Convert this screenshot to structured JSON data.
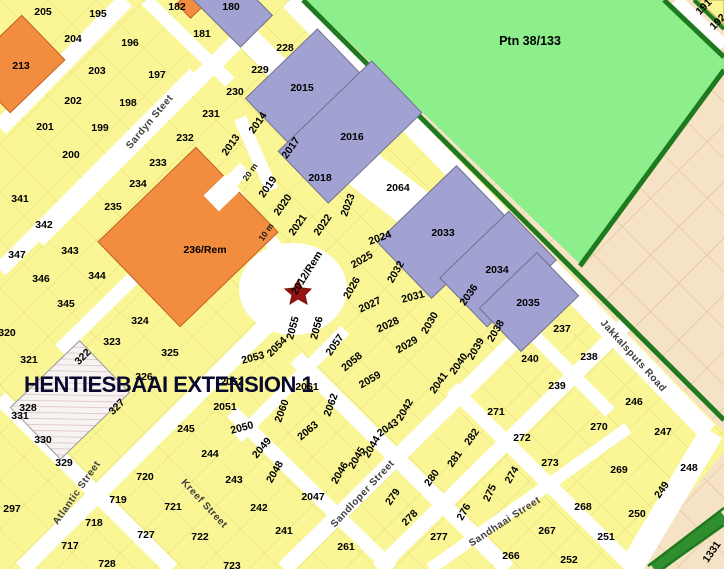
{
  "map": {
    "title": "HENTIESBAAI EXTENSION 1",
    "region_label": {
      "label": "Ptn 38/133",
      "x": 530,
      "y": 41
    },
    "marker": {
      "name": "red-star-marker",
      "x": 298,
      "y": 291,
      "color": "#9a1212"
    },
    "colors": {
      "parcel_yellow": "#faf695",
      "parcel_orange": "#f28c3e",
      "parcel_purple": "#a2a2d2",
      "open_space_green": "#8cef8c",
      "border_dark_green": "#1f7a1f",
      "road_median_green": "#2f8f2f",
      "adjacent_area_beige": "#f6e2c4",
      "road_white": "#ffffff",
      "title_navy": "#0a0a2e"
    },
    "streets": [
      {
        "label": "Sardyn Steet",
        "x": 150,
        "y": 122,
        "rot": -50
      },
      {
        "label": "Atlantic Street",
        "x": 77,
        "y": 493,
        "rot": -55
      },
      {
        "label": "Kreef Street",
        "x": 204,
        "y": 504,
        "rot": 47
      },
      {
        "label": "Sandloper Street",
        "x": 363,
        "y": 494,
        "rot": -47
      },
      {
        "label": "Sandhaai Street",
        "x": 505,
        "y": 522,
        "rot": -33
      },
      {
        "label": "Jakkalsputs Road",
        "x": 633,
        "y": 356,
        "rot": 48
      }
    ],
    "annotations": [
      {
        "label": "20 m",
        "x": 250,
        "y": 172,
        "rot": -55
      },
      {
        "label": "10 m",
        "x": 266,
        "y": 232,
        "rot": -55
      }
    ],
    "parcels": [
      {
        "label": "205",
        "x": 43,
        "y": 12,
        "rot": 0
      },
      {
        "label": "195",
        "x": 98,
        "y": 14,
        "rot": 0
      },
      {
        "label": "182",
        "x": 177,
        "y": 7,
        "rot": 0
      },
      {
        "label": "180",
        "x": 231,
        "y": 7,
        "rot": 0
      },
      {
        "label": "204",
        "x": 73,
        "y": 39,
        "rot": 0
      },
      {
        "label": "196",
        "x": 130,
        "y": 43,
        "rot": 0
      },
      {
        "label": "181",
        "x": 202,
        "y": 34,
        "rot": 0
      },
      {
        "label": "228",
        "x": 285,
        "y": 48,
        "rot": 0
      },
      {
        "label": "229",
        "x": 260,
        "y": 70,
        "rot": 0
      },
      {
        "label": "230",
        "x": 235,
        "y": 92,
        "rot": 0
      },
      {
        "label": "231",
        "x": 211,
        "y": 114,
        "rot": 0
      },
      {
        "label": "232",
        "x": 185,
        "y": 138,
        "rot": 0
      },
      {
        "label": "233",
        "x": 158,
        "y": 163,
        "rot": 0
      },
      {
        "label": "234",
        "x": 138,
        "y": 184,
        "rot": 0
      },
      {
        "label": "235",
        "x": 113,
        "y": 207,
        "rot": 0
      },
      {
        "label": "213",
        "x": 21,
        "y": 66,
        "rot": 0
      },
      {
        "label": "203",
        "x": 97,
        "y": 71,
        "rot": 0
      },
      {
        "label": "197",
        "x": 157,
        "y": 75,
        "rot": 0
      },
      {
        "label": "202",
        "x": 73,
        "y": 101,
        "rot": 0
      },
      {
        "label": "198",
        "x": 128,
        "y": 103,
        "rot": 0
      },
      {
        "label": "201",
        "x": 45,
        "y": 127,
        "rot": 0
      },
      {
        "label": "199",
        "x": 100,
        "y": 128,
        "rot": 0
      },
      {
        "label": "200",
        "x": 71,
        "y": 155,
        "rot": 0
      },
      {
        "label": "341",
        "x": 20,
        "y": 199,
        "rot": 0
      },
      {
        "label": "342",
        "x": 44,
        "y": 225,
        "rot": 0
      },
      {
        "label": "347",
        "x": 17,
        "y": 255,
        "rot": 0
      },
      {
        "label": "343",
        "x": 70,
        "y": 251,
        "rot": 0
      },
      {
        "label": "346",
        "x": 41,
        "y": 279,
        "rot": 0
      },
      {
        "label": "344",
        "x": 97,
        "y": 276,
        "rot": 0
      },
      {
        "label": "345",
        "x": 66,
        "y": 304,
        "rot": 0
      },
      {
        "label": "320",
        "x": 7,
        "y": 333,
        "rot": 0
      },
      {
        "label": "324",
        "x": 140,
        "y": 321,
        "rot": 0
      },
      {
        "label": "321",
        "x": 29,
        "y": 360,
        "rot": 0
      },
      {
        "label": "323",
        "x": 112,
        "y": 342,
        "rot": 0
      },
      {
        "label": "325",
        "x": 170,
        "y": 353,
        "rot": 0
      },
      {
        "label": "322",
        "x": 83,
        "y": 357,
        "rot": -45
      },
      {
        "label": "326",
        "x": 144,
        "y": 377,
        "rot": 0
      },
      {
        "label": "327",
        "x": 117,
        "y": 407,
        "rot": -45
      },
      {
        "label": "328",
        "x": 28,
        "y": 408,
        "rot": 0
      },
      {
        "label": "331",
        "x": 20,
        "y": 416,
        "rot": 0
      },
      {
        "label": "330",
        "x": 43,
        "y": 440,
        "rot": 0
      },
      {
        "label": "329",
        "x": 64,
        "y": 463,
        "rot": 0
      },
      {
        "label": "297",
        "x": 12,
        "y": 509,
        "rot": 0
      },
      {
        "label": "717",
        "x": 70,
        "y": 546,
        "rot": 0
      },
      {
        "label": "718",
        "x": 94,
        "y": 523,
        "rot": 0
      },
      {
        "label": "719",
        "x": 118,
        "y": 500,
        "rot": 0
      },
      {
        "label": "720",
        "x": 145,
        "y": 477,
        "rot": 0
      },
      {
        "label": "727",
        "x": 146,
        "y": 535,
        "rot": 0
      },
      {
        "label": "721",
        "x": 173,
        "y": 507,
        "rot": 0
      },
      {
        "label": "722",
        "x": 200,
        "y": 537,
        "rot": 0
      },
      {
        "label": "728",
        "x": 107,
        "y": 564,
        "rot": 0
      },
      {
        "label": "723",
        "x": 232,
        "y": 566,
        "rot": 0
      },
      {
        "label": "245",
        "x": 186,
        "y": 429,
        "rot": 0
      },
      {
        "label": "244",
        "x": 210,
        "y": 454,
        "rot": 0
      },
      {
        "label": "243",
        "x": 234,
        "y": 480,
        "rot": 0
      },
      {
        "label": "242",
        "x": 259,
        "y": 508,
        "rot": 0
      },
      {
        "label": "241",
        "x": 284,
        "y": 531,
        "rot": 0
      },
      {
        "label": "261",
        "x": 346,
        "y": 547,
        "rot": 0
      },
      {
        "label": "191",
        "x": 704,
        "y": 7,
        "rot": -45
      },
      {
        "label": "192",
        "x": 718,
        "y": 22,
        "rot": -45
      },
      {
        "label": "236/Rem",
        "x": 205,
        "y": 250,
        "rot": 0
      },
      {
        "label": "2012/Rem",
        "x": 307,
        "y": 273,
        "rot": -58
      },
      {
        "label": "2013",
        "x": 231,
        "y": 145,
        "rot": -55
      },
      {
        "label": "2014",
        "x": 258,
        "y": 123,
        "rot": -55
      },
      {
        "label": "2015",
        "x": 302,
        "y": 88,
        "rot": 0
      },
      {
        "label": "2016",
        "x": 352,
        "y": 137,
        "rot": 0
      },
      {
        "label": "2017",
        "x": 291,
        "y": 148,
        "rot": -55
      },
      {
        "label": "2018",
        "x": 320,
        "y": 178,
        "rot": 0
      },
      {
        "label": "2019",
        "x": 268,
        "y": 187,
        "rot": -55
      },
      {
        "label": "2020",
        "x": 283,
        "y": 205,
        "rot": -55
      },
      {
        "label": "2021",
        "x": 298,
        "y": 225,
        "rot": -55
      },
      {
        "label": "2022",
        "x": 323,
        "y": 225,
        "rot": -55
      },
      {
        "label": "2023",
        "x": 348,
        "y": 205,
        "rot": -70
      },
      {
        "label": "2024",
        "x": 380,
        "y": 238,
        "rot": -20
      },
      {
        "label": "2025",
        "x": 362,
        "y": 260,
        "rot": -30
      },
      {
        "label": "2026",
        "x": 352,
        "y": 288,
        "rot": -60
      },
      {
        "label": "2027",
        "x": 370,
        "y": 305,
        "rot": -25
      },
      {
        "label": "2028",
        "x": 388,
        "y": 325,
        "rot": -25
      },
      {
        "label": "2029",
        "x": 407,
        "y": 345,
        "rot": -30
      },
      {
        "label": "2030",
        "x": 430,
        "y": 323,
        "rot": -60
      },
      {
        "label": "2031",
        "x": 413,
        "y": 297,
        "rot": -15
      },
      {
        "label": "2032",
        "x": 396,
        "y": 272,
        "rot": -60
      },
      {
        "label": "2033",
        "x": 443,
        "y": 233,
        "rot": 0
      },
      {
        "label": "2034",
        "x": 497,
        "y": 270,
        "rot": 0
      },
      {
        "label": "2035",
        "x": 528,
        "y": 303,
        "rot": 0
      },
      {
        "label": "2036",
        "x": 469,
        "y": 295,
        "rot": -55
      },
      {
        "label": "2038",
        "x": 496,
        "y": 331,
        "rot": -60
      },
      {
        "label": "2039",
        "x": 476,
        "y": 349,
        "rot": -60
      },
      {
        "label": "2040",
        "x": 459,
        "y": 364,
        "rot": -55
      },
      {
        "label": "2041",
        "x": 439,
        "y": 383,
        "rot": -55
      },
      {
        "label": "2042",
        "x": 405,
        "y": 410,
        "rot": -60
      },
      {
        "label": "2043",
        "x": 388,
        "y": 428,
        "rot": -35
      },
      {
        "label": "2044",
        "x": 372,
        "y": 447,
        "rot": -60
      },
      {
        "label": "2045",
        "x": 357,
        "y": 458,
        "rot": -60
      },
      {
        "label": "2046",
        "x": 340,
        "y": 473,
        "rot": -60
      },
      {
        "label": "2047",
        "x": 313,
        "y": 497,
        "rot": 0
      },
      {
        "label": "2048",
        "x": 275,
        "y": 472,
        "rot": -60
      },
      {
        "label": "2049",
        "x": 262,
        "y": 448,
        "rot": -50
      },
      {
        "label": "2050",
        "x": 242,
        "y": 428,
        "rot": -15
      },
      {
        "label": "2051",
        "x": 225,
        "y": 407,
        "rot": 0
      },
      {
        "label": "2052",
        "x": 232,
        "y": 382,
        "rot": 0
      },
      {
        "label": "2053",
        "x": 253,
        "y": 358,
        "rot": -15
      },
      {
        "label": "2054",
        "x": 277,
        "y": 347,
        "rot": -45
      },
      {
        "label": "2055",
        "x": 293,
        "y": 328,
        "rot": -75
      },
      {
        "label": "2056",
        "x": 317,
        "y": 328,
        "rot": -75
      },
      {
        "label": "2057",
        "x": 335,
        "y": 345,
        "rot": -55
      },
      {
        "label": "2058",
        "x": 352,
        "y": 362,
        "rot": -40
      },
      {
        "label": "2059",
        "x": 370,
        "y": 380,
        "rot": -30
      },
      {
        "label": "2060",
        "x": 282,
        "y": 411,
        "rot": -70
      },
      {
        "label": "2061",
        "x": 307,
        "y": 387,
        "rot": 0
      },
      {
        "label": "2062",
        "x": 331,
        "y": 405,
        "rot": -70
      },
      {
        "label": "2063",
        "x": 308,
        "y": 431,
        "rot": -40
      },
      {
        "label": "2064",
        "x": 398,
        "y": 188,
        "rot": 0
      },
      {
        "label": "237",
        "x": 562,
        "y": 329,
        "rot": 0
      },
      {
        "label": "238",
        "x": 589,
        "y": 357,
        "rot": 0
      },
      {
        "label": "239",
        "x": 557,
        "y": 386,
        "rot": 0
      },
      {
        "label": "240",
        "x": 530,
        "y": 359,
        "rot": 0
      },
      {
        "label": "246",
        "x": 634,
        "y": 402,
        "rot": 0
      },
      {
        "label": "247",
        "x": 663,
        "y": 432,
        "rot": 0
      },
      {
        "label": "248",
        "x": 689,
        "y": 468,
        "rot": 0
      },
      {
        "label": "249",
        "x": 662,
        "y": 490,
        "rot": -55
      },
      {
        "label": "250",
        "x": 637,
        "y": 514,
        "rot": 0
      },
      {
        "label": "251",
        "x": 606,
        "y": 537,
        "rot": 0
      },
      {
        "label": "252",
        "x": 569,
        "y": 560,
        "rot": 0
      },
      {
        "label": "266",
        "x": 511,
        "y": 556,
        "rot": 0
      },
      {
        "label": "267",
        "x": 547,
        "y": 531,
        "rot": 0
      },
      {
        "label": "268",
        "x": 583,
        "y": 507,
        "rot": 0
      },
      {
        "label": "269",
        "x": 619,
        "y": 470,
        "rot": 0
      },
      {
        "label": "270",
        "x": 599,
        "y": 427,
        "rot": 0
      },
      {
        "label": "271",
        "x": 496,
        "y": 412,
        "rot": 0
      },
      {
        "label": "272",
        "x": 522,
        "y": 438,
        "rot": 0
      },
      {
        "label": "273",
        "x": 550,
        "y": 463,
        "rot": 0
      },
      {
        "label": "274",
        "x": 512,
        "y": 475,
        "rot": -60
      },
      {
        "label": "275",
        "x": 490,
        "y": 493,
        "rot": -65
      },
      {
        "label": "276",
        "x": 464,
        "y": 512,
        "rot": -60
      },
      {
        "label": "277",
        "x": 439,
        "y": 537,
        "rot": 0
      },
      {
        "label": "278",
        "x": 410,
        "y": 518,
        "rot": -45
      },
      {
        "label": "279",
        "x": 393,
        "y": 497,
        "rot": -55
      },
      {
        "label": "280",
        "x": 432,
        "y": 478,
        "rot": -55
      },
      {
        "label": "281",
        "x": 455,
        "y": 459,
        "rot": -55
      },
      {
        "label": "282",
        "x": 472,
        "y": 437,
        "rot": -55
      },
      {
        "label": "1331",
        "x": 712,
        "y": 552,
        "rot": -55
      }
    ]
  }
}
